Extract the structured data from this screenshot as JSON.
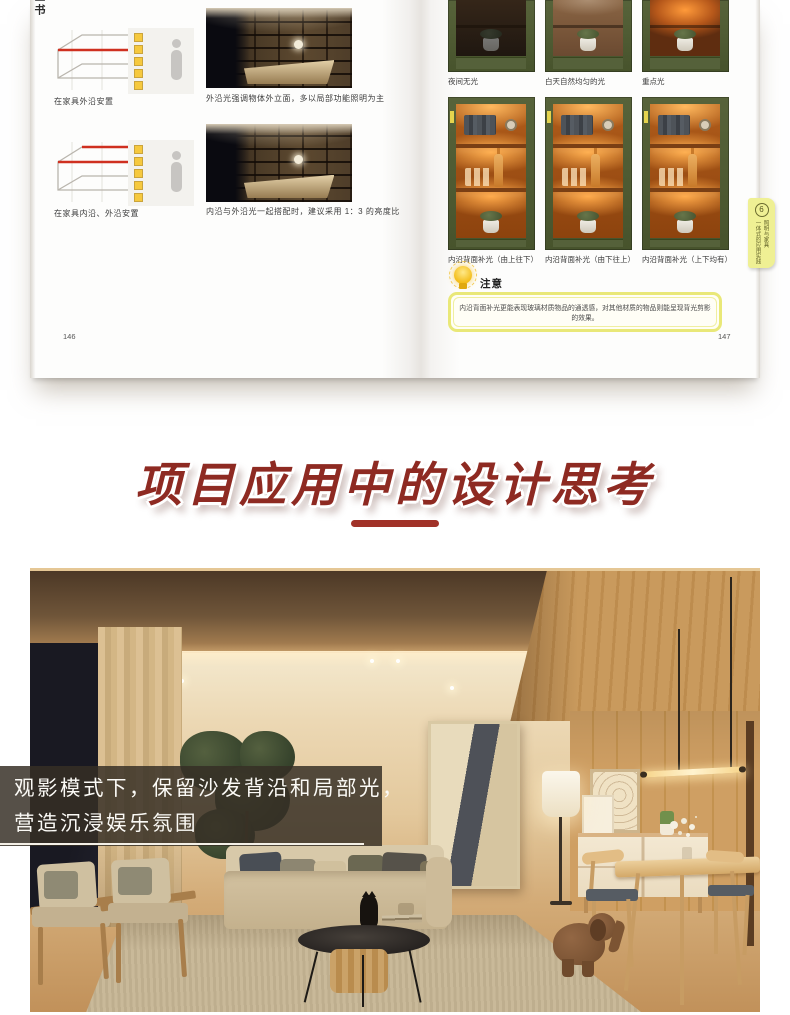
{
  "book": {
    "edge_text": "全书",
    "left_page": {
      "rows": [
        {
          "diagram_caption": "在家具外沿安置",
          "photo_caption": "外沿光强调物体外立面，多以局部功能照明为主"
        },
        {
          "diagram_caption": "在家具内沿、外沿安置",
          "photo_caption": "内沿与外沿光一起搭配时，建议采用 1：3 的亮度比"
        }
      ],
      "page_number": "146"
    },
    "right_page": {
      "row1_captions": [
        "夜间无光",
        "白天自然均匀的光",
        "重点光"
      ],
      "row2_captions": [
        "内沿背面补光（由上往下）",
        "内沿背面补光（由下往上）",
        "内沿背面补光（上下均有）"
      ],
      "tab": {
        "number": "6",
        "line_right": "照明与家具",
        "line_left": "一体式的应用实践"
      },
      "note": {
        "title": "注意",
        "body": "内沿背面补光更能表现玻璃材质物品的通透感，对其他材质的物品则能呈现背光剪影的效果。"
      },
      "page_number": "147"
    }
  },
  "headline": {
    "text": "项目应用中的设计思考"
  },
  "hero_caption": {
    "line1": "观影模式下，保留沙发背沿和局部光，",
    "line2": "营造沉浸娱乐氛围"
  },
  "colors": {
    "headline_red": "#8e2a22",
    "cabinet_green": "#4e5a30",
    "note_border_yellow": "#e9e878",
    "tab_yellow": "#eff094",
    "accent_strip_yellow": "#f6c93e"
  }
}
